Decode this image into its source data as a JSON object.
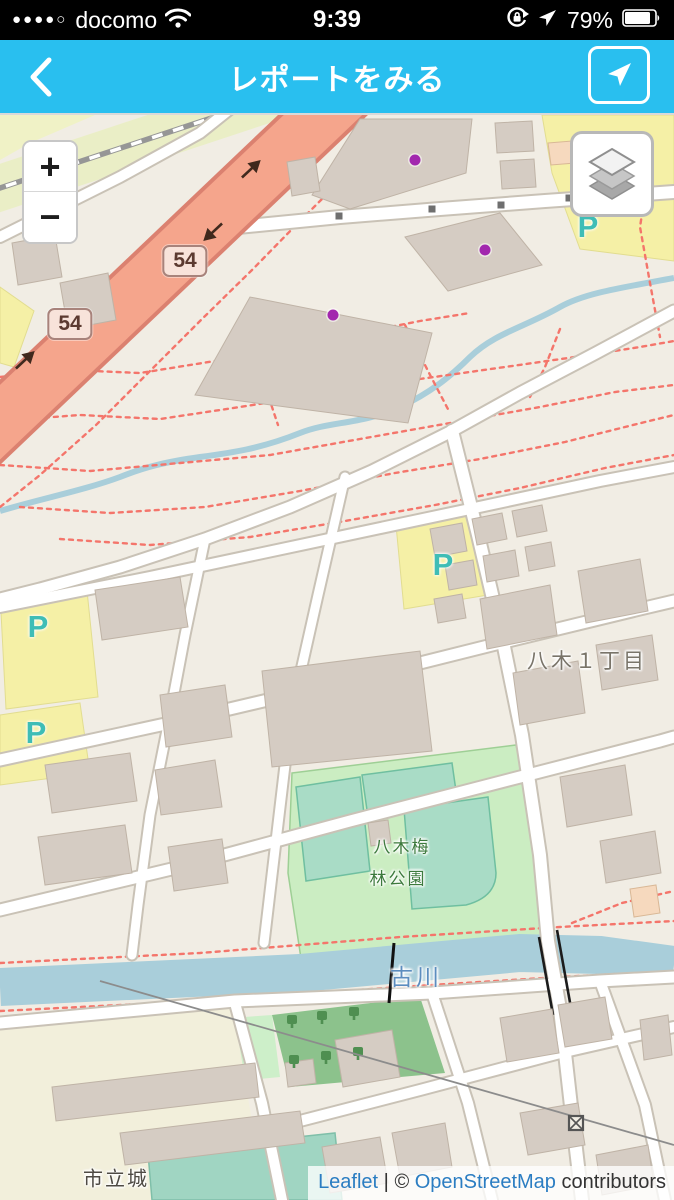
{
  "status_bar": {
    "signal_dots": "●●●●○",
    "carrier": "docomo",
    "time": "9:39",
    "battery_percent": "79%"
  },
  "header": {
    "title": "レポートをみる"
  },
  "map": {
    "controls": {
      "zoom_in": "+",
      "zoom_out": "−"
    },
    "labels": {
      "district": "八木１丁目",
      "park_line1": "八木梅",
      "park_line2": "林公園",
      "river": "古川",
      "school": "市立城",
      "parking": "P"
    },
    "route_shields": [
      {
        "label": "54",
        "x": 185,
        "y": 146
      },
      {
        "label": "54",
        "x": 70,
        "y": 209
      }
    ],
    "parking_labels": [
      {
        "x": 588,
        "y": 112
      },
      {
        "x": 443,
        "y": 450
      },
      {
        "x": 38,
        "y": 512
      },
      {
        "x": 36,
        "y": 618
      }
    ],
    "markers": [
      {
        "x": 415,
        "y": 45
      },
      {
        "x": 485,
        "y": 135
      },
      {
        "x": 333,
        "y": 200
      }
    ],
    "attribution": {
      "leaflet": "Leaflet",
      "separator": " | ",
      "copyright": "© ",
      "osm": "OpenStreetMap",
      "contributors": " contributors"
    },
    "colors": {
      "header_blue": "#29BFEF",
      "trunk_road": "#F5A58C",
      "water": "#A9CEDA",
      "park_green": "#CBEDC2",
      "parking_yellow": "#F5F0A6",
      "marker_purple": "#A227AE",
      "path_red": "#F4756B"
    }
  }
}
